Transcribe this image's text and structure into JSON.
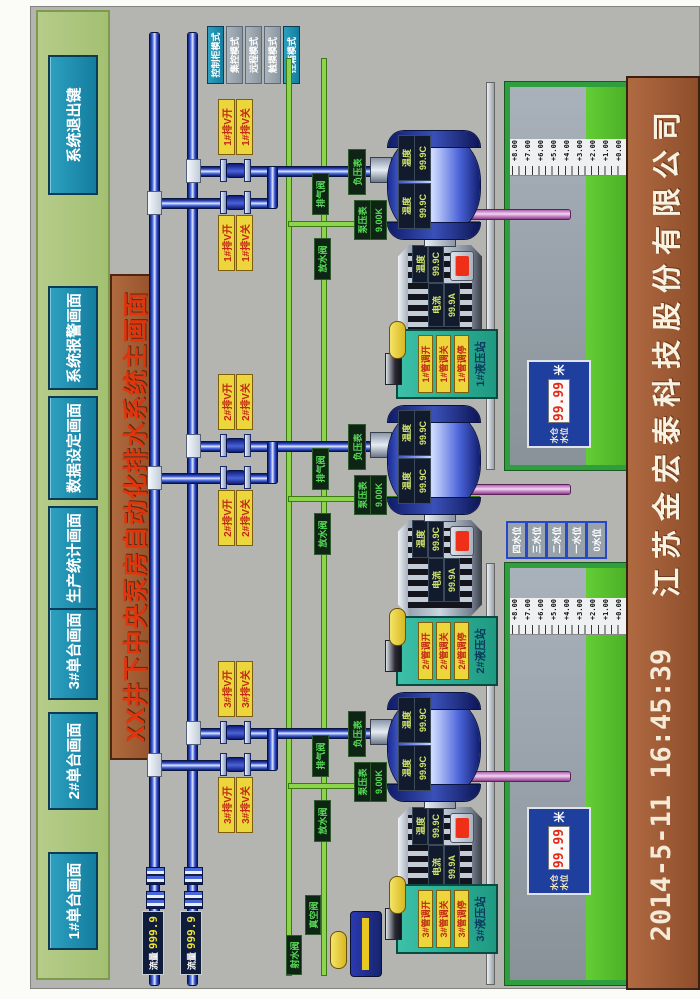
{
  "top_buttons": [
    "1#单台画面",
    "2#单台画面",
    "3#单台画面",
    "生产统计画面",
    "数据设定画面",
    "系统报警画面",
    "系统退出键"
  ],
  "title": "XX井下中央泵房自动化排水系统主画面",
  "mode_buttons": [
    "控制柜模式",
    "集控模式",
    "远程模式",
    "触摸模式",
    "控箱模式"
  ],
  "flow_meters": [
    {
      "label": "流量",
      "value": "999.9"
    },
    {
      "label": "流量",
      "value": "999.9"
    }
  ],
  "level_buttons": [
    "四水位",
    "三水位",
    "二水位",
    "一水位",
    "0水位"
  ],
  "station": {
    "jet_valve": "射水阀",
    "vacuum_valve": "真空阀"
  },
  "pools": [
    {
      "scale": [
        "+8.00",
        "+7.00",
        "+6.00",
        "+5.00",
        "+4.00",
        "+3.00",
        "+2.00",
        "+1.00",
        "+0.00"
      ],
      "readout": {
        "label_line1": "水仓",
        "label_line2": "水位",
        "value": "99.99",
        "unit": "米"
      }
    },
    {
      "scale": [
        "+8.00",
        "+7.00",
        "+6.00",
        "+5.00",
        "+4.00",
        "+3.00",
        "+2.00",
        "+1.00",
        "+0.00"
      ],
      "readout": {
        "label_line1": "水仓",
        "label_line2": "水位",
        "value": "99.99",
        "unit": "米"
      }
    }
  ],
  "units": [
    {
      "id": "3#",
      "valve_a_open": "3#排V开",
      "valve_a_close": "3#排V关",
      "valve_b_open": "3#排V开",
      "valve_b_close": "3#排V关",
      "vacuum_gauge": "负压表",
      "pump_gauge_label": "泵压表",
      "pump_gauge_value": "9.00K",
      "air_valve": "排气阀",
      "drain_valve": "放水阀",
      "pump_temp1_label": "温度",
      "pump_temp1_value": "99.9C",
      "pump_temp2_label": "温度",
      "pump_temp2_value": "99.9C",
      "motor_current_label": "电流",
      "motor_current_value": "99.9A",
      "motor_temp_label": "温度",
      "motor_temp_value": "99.9C",
      "hyd_title": "3#液压站",
      "hyd_btn_open": "3#管调开",
      "hyd_btn_close": "3#管调关",
      "hyd_btn_stop": "3#管调停"
    },
    {
      "id": "2#",
      "valve_a_open": "2#排V开",
      "valve_a_close": "2#排V关",
      "valve_b_open": "2#排V开",
      "valve_b_close": "2#排V关",
      "vacuum_gauge": "负压表",
      "pump_gauge_label": "泵压表",
      "pump_gauge_value": "9.00K",
      "air_valve": "排气阀",
      "drain_valve": "放水阀",
      "pump_temp1_label": "温度",
      "pump_temp1_value": "99.9C",
      "pump_temp2_label": "温度",
      "pump_temp2_value": "99.9C",
      "motor_current_label": "电流",
      "motor_current_value": "99.9A",
      "motor_temp_label": "温度",
      "motor_temp_value": "99.9C",
      "hyd_title": "2#液压站",
      "hyd_btn_open": "2#管调开",
      "hyd_btn_close": "2#管调关",
      "hyd_btn_stop": "2#管调停"
    },
    {
      "id": "1#",
      "valve_a_open": "1#排V开",
      "valve_a_close": "1#排V关",
      "valve_b_open": "1#排V开",
      "valve_b_close": "1#排V关",
      "vacuum_gauge": "负压表",
      "pump_gauge_label": "泵压表",
      "pump_gauge_value": "9.00K",
      "air_valve": "排气阀",
      "drain_valve": "放水阀",
      "pump_temp1_label": "温度",
      "pump_temp1_value": "99.9C",
      "pump_temp2_label": "温度",
      "pump_temp2_value": "99.9C",
      "motor_current_label": "电流",
      "motor_current_value": "99.9A",
      "motor_temp_label": "温度",
      "motor_temp_value": "99.9C",
      "hyd_title": "1#液压站",
      "hyd_btn_open": "1#管调开",
      "hyd_btn_close": "1#管调关",
      "hyd_btn_stop": "1#管调停"
    }
  ],
  "footer": {
    "datetime": "2014-5-11  16:45:39",
    "company": "江苏金宏泰科技股份有限公司"
  }
}
